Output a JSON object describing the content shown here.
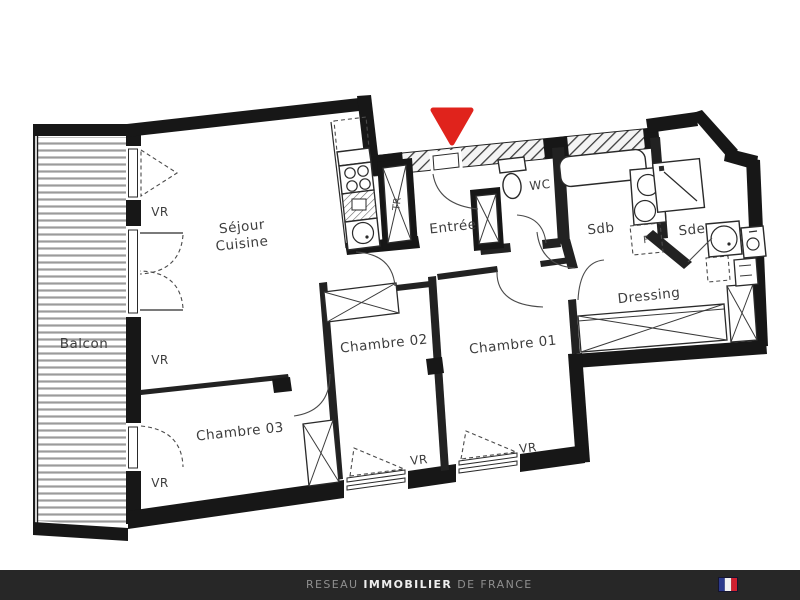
{
  "plan": {
    "rooms": {
      "balcon": "Balcon",
      "sejour_line1": "Séjour",
      "sejour_line2": "Cuisine",
      "entree": "Entrée",
      "wc": "WC",
      "sdb": "Sdb",
      "sde": "Sde",
      "dressing": "Dressing",
      "chambre01": "Chambre 01",
      "chambre02": "Chambre 02",
      "chambre03": "Chambre 03"
    },
    "annotations": {
      "vr": "VR",
      "tr": "TR",
      "f": "F"
    },
    "colors": {
      "arrow_red": "#e0231c",
      "wall_black": "#171717"
    }
  },
  "footer": {
    "brand_part1": "RESEAU ",
    "brand_part2": "IMMOBILIER",
    "brand_part3": " DE FRANCE",
    "bg": "#272727",
    "flag": {
      "blue": "#2c3a8c",
      "white": "#f2f2f2",
      "red": "#cf2131"
    }
  }
}
